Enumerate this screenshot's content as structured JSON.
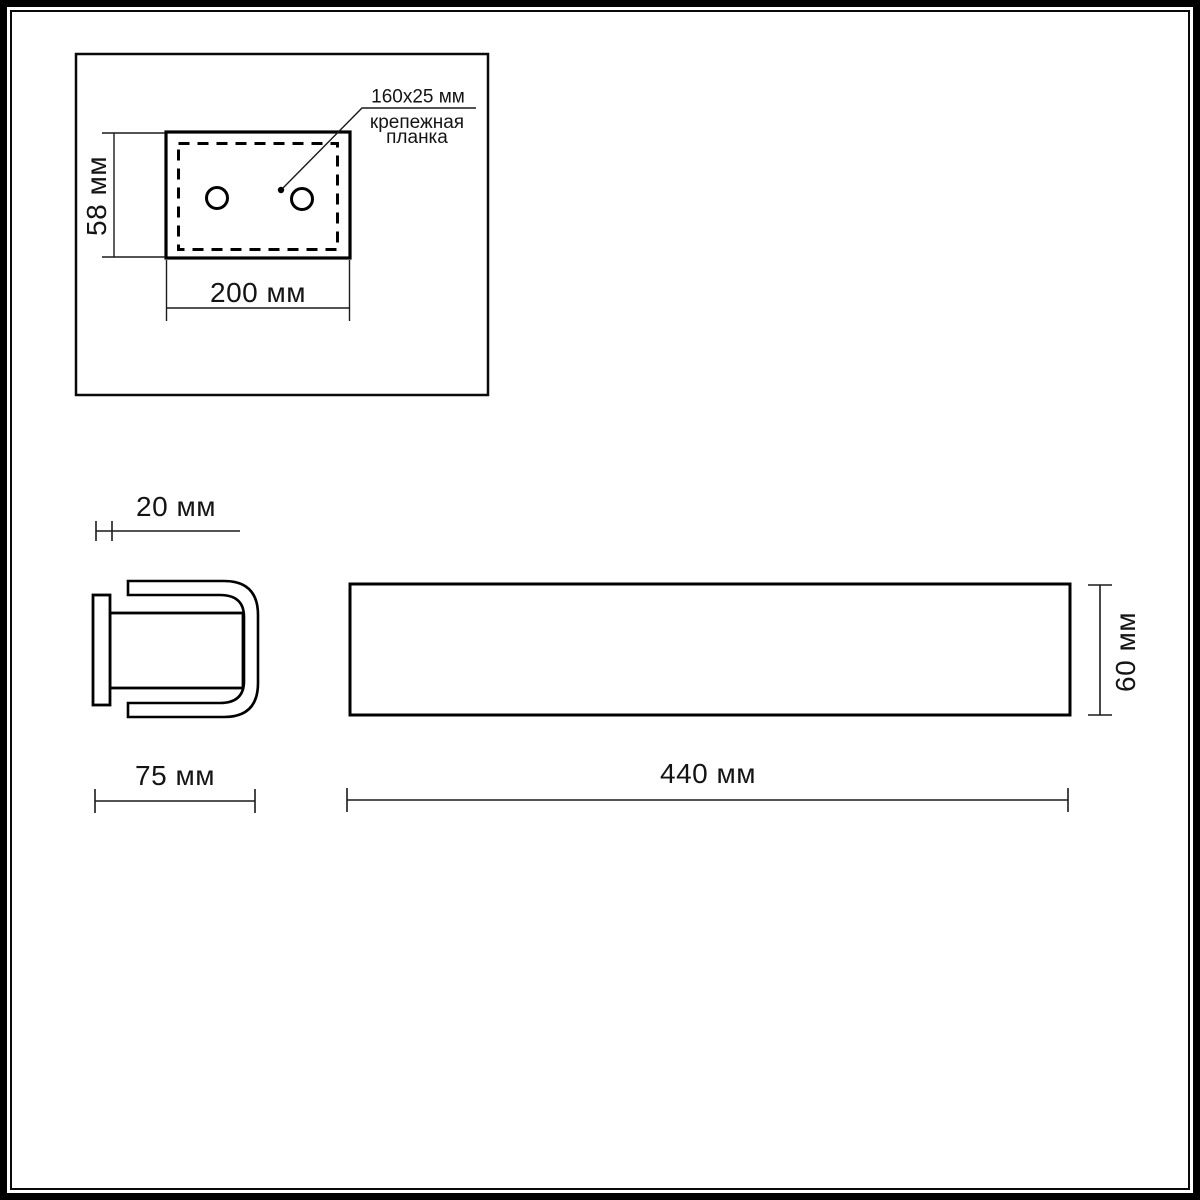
{
  "drawing": {
    "kind": "technical-dimension-drawing",
    "units": "мм",
    "colors": {
      "line": "#000000",
      "background": "#ffffff"
    }
  },
  "top_view": {
    "height_label": "58 мм",
    "width_label": "200 мм",
    "callout": {
      "size_label": "160x25 мм",
      "name_line1": "крепежная",
      "name_line2": "планка"
    }
  },
  "side_view": {
    "plate_thickness_label": "20 мм",
    "depth_label": "75 мм"
  },
  "front_view": {
    "width_label": "440 мм",
    "height_label": "60 мм"
  }
}
